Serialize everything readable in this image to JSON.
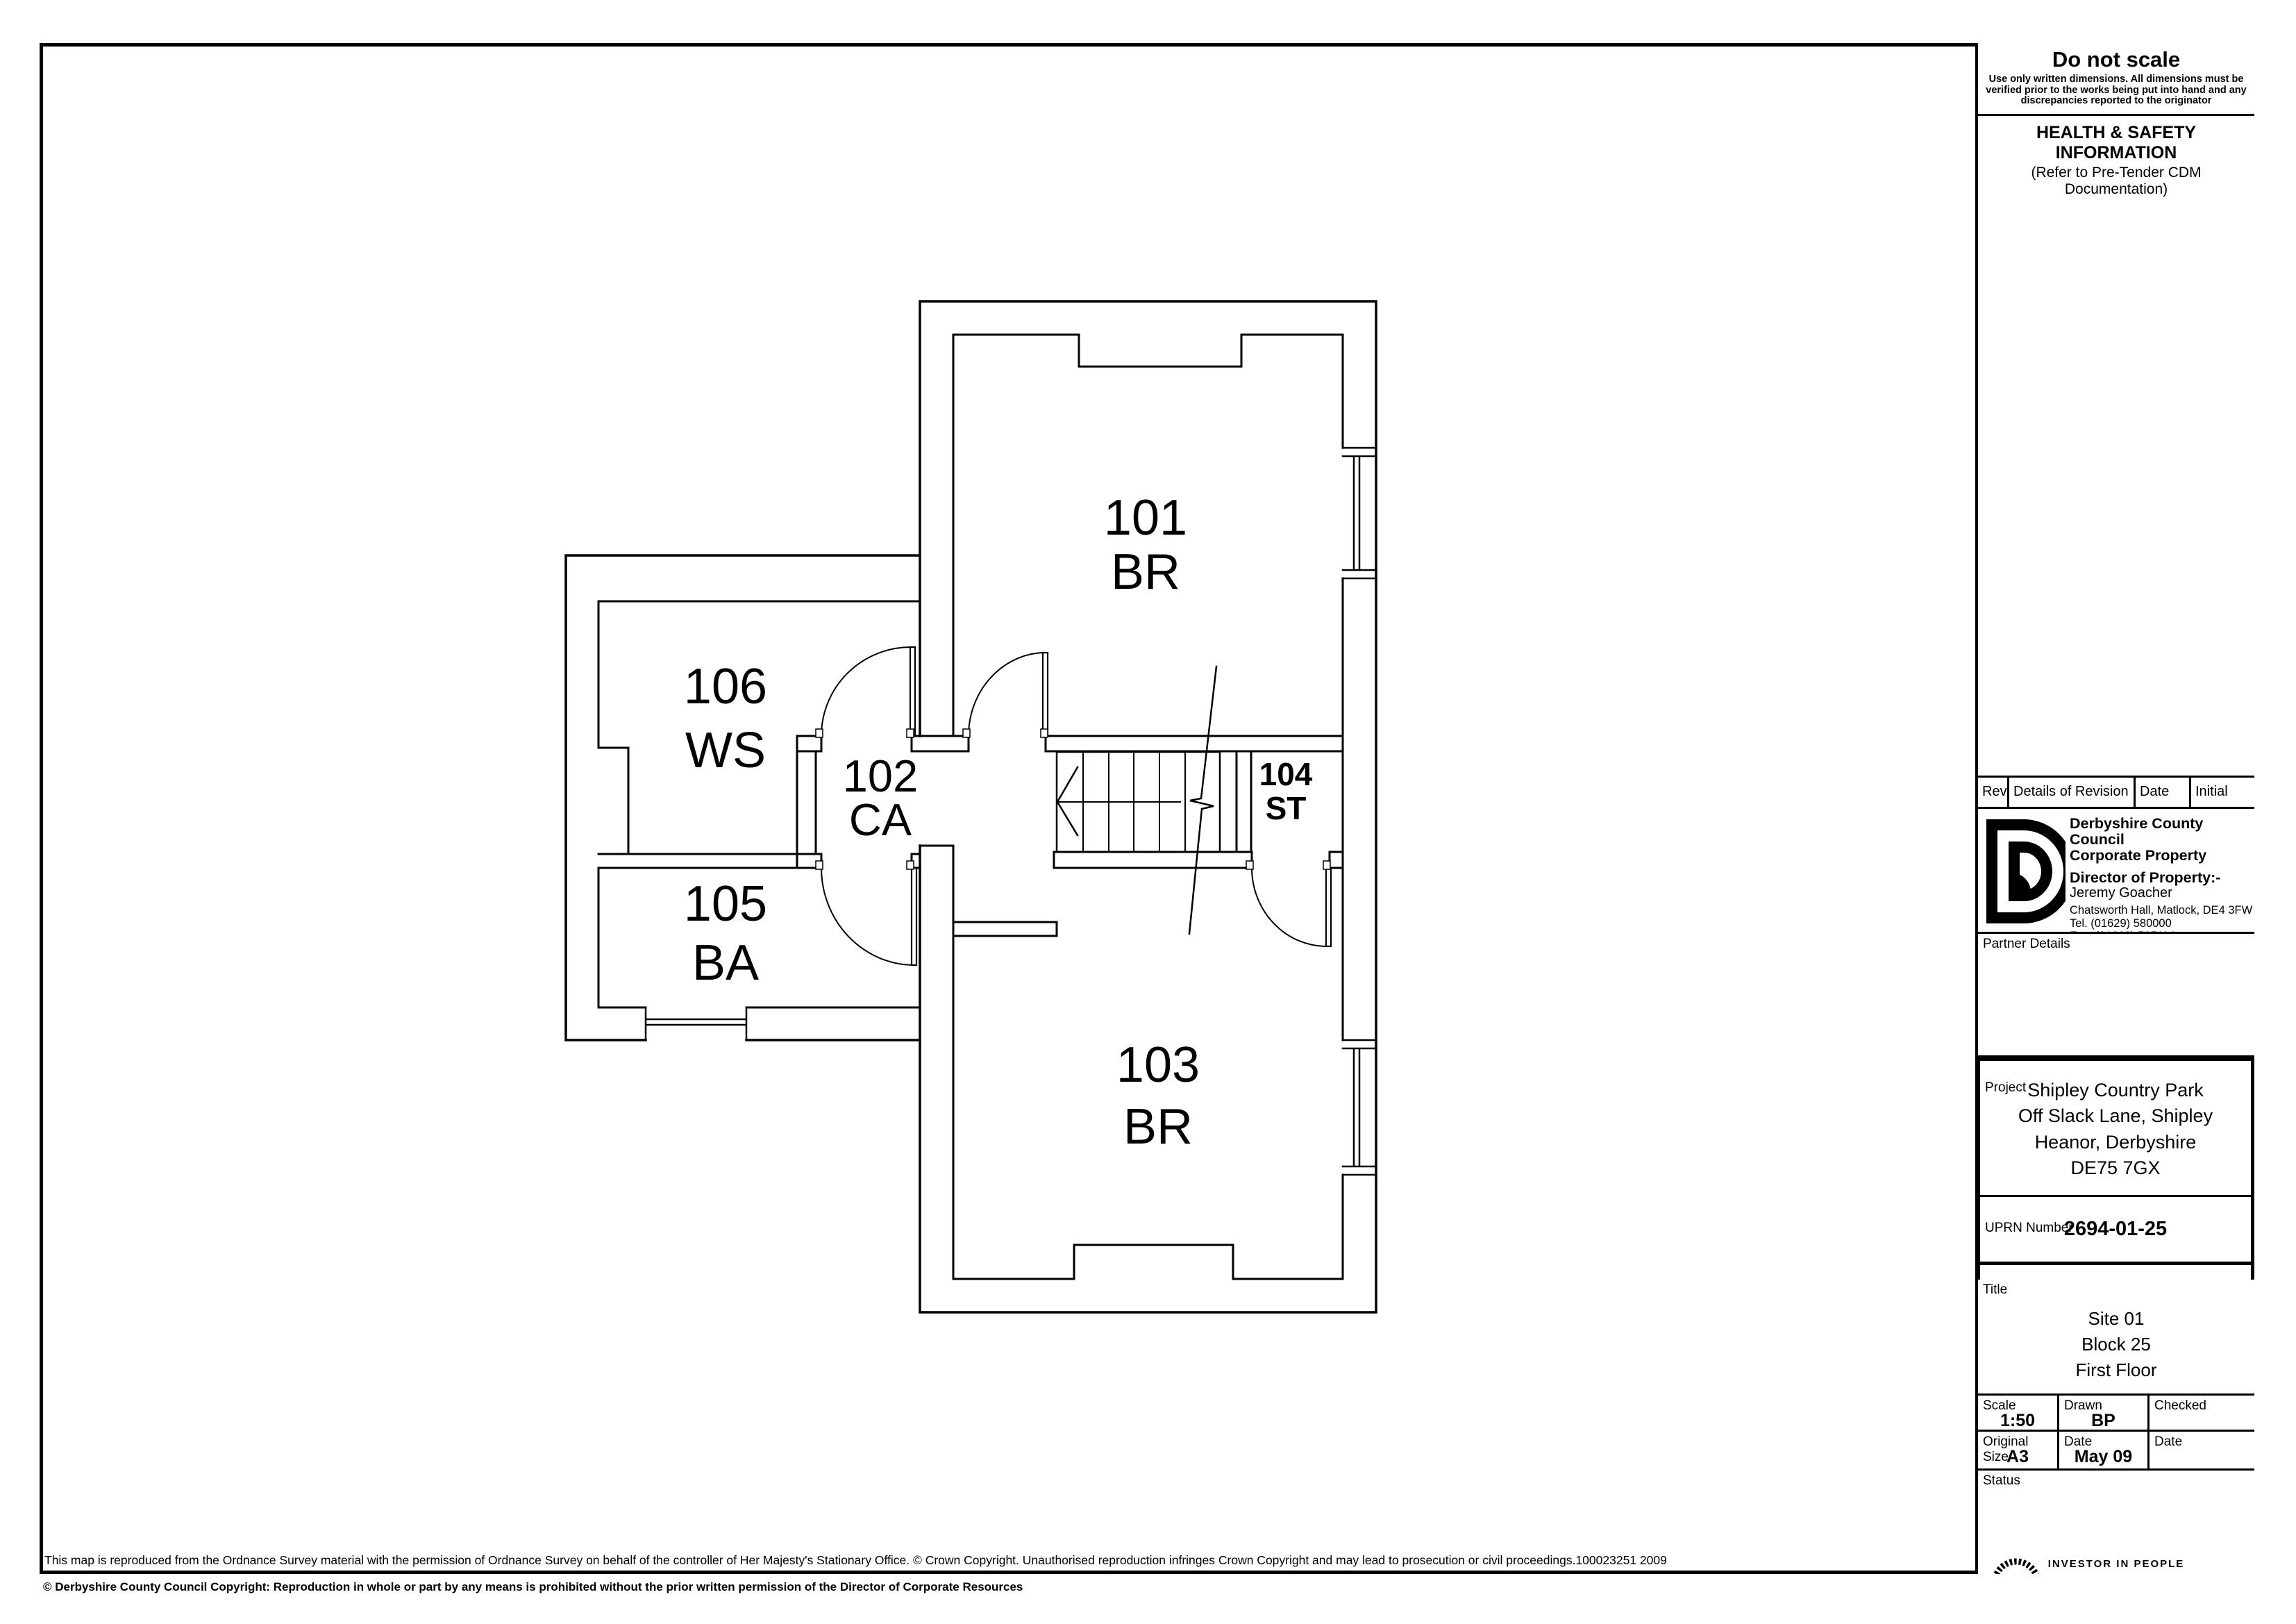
{
  "plan": {
    "rooms": [
      {
        "number": "101",
        "code": "BR"
      },
      {
        "number": "102",
        "code": "CA"
      },
      {
        "number": "103",
        "code": "BR"
      },
      {
        "number": "104",
        "code": "ST"
      },
      {
        "number": "105",
        "code": "BA"
      },
      {
        "number": "106",
        "code": "WS"
      }
    ]
  },
  "titleblock": {
    "do_not_scale": {
      "title": "Do not scale",
      "note": "Use only written dimensions.  All dimensions must be verified prior to the works being put into hand and any discrepancies reported to the originator"
    },
    "health_safety": {
      "title": "HEALTH & SAFETY INFORMATION",
      "subtitle": "(Refer to Pre-Tender CDM Documentation)"
    },
    "revision_table": {
      "headers": [
        "Rev.",
        "Details of Revision",
        "Date",
        "Initial"
      ]
    },
    "council": {
      "name": "Derbyshire County Council",
      "dept": "Corporate Property",
      "director_label": "Director of Property:-",
      "director": "Jeremy Goacher",
      "address": "Chatsworth Hall, Matlock, DE4 3FW",
      "tel": "Tel. (01629) 580000",
      "fax": "Fax. (01629) 585114"
    },
    "partner_details_label": "Partner Details",
    "project": {
      "label": "Project",
      "line1": "Shipley Country Park",
      "line2": "Off Slack Lane, Shipley",
      "line3": "Heanor, Derbyshire",
      "line4": "DE75 7GX"
    },
    "uprn": {
      "label": "UPRN Number",
      "value": "2694-01-25"
    },
    "drawing_number": {
      "label": "Drawing Number",
      "value": "2694-01-Block 25-FF"
    },
    "revision_box_label": "Revision",
    "title_section": {
      "label": "Title",
      "line1": "Site 01",
      "line2": "Block 25",
      "line3": "First Floor"
    },
    "scale": {
      "label": "Scale",
      "value": "1:50"
    },
    "drawn": {
      "label": "Drawn",
      "value": "BP"
    },
    "checked": {
      "label": "Checked",
      "value": ""
    },
    "original_size": {
      "label": "Original Size",
      "value": "A3"
    },
    "date_drawn": {
      "label": "Date",
      "value": "May 09"
    },
    "date_checked": {
      "label": "Date",
      "value": ""
    },
    "status_label": "Status",
    "iip_text": "INVESTOR IN PEOPLE"
  },
  "footer": {
    "line1": "This map is reproduced from the Ordnance Survey material with the permission of Ordnance Survey on behalf of the controller of Her Majesty's Stationary Office. © Crown Copyright. Unauthorised reproduction infringes Crown Copyright and may lead to prosecution or civil proceedings.100023251 2009",
    "line2": "© Derbyshire County Council Copyright:  Reproduction in whole or part by any means is prohibited without the prior written permission of the Director of Corporate Resources"
  }
}
